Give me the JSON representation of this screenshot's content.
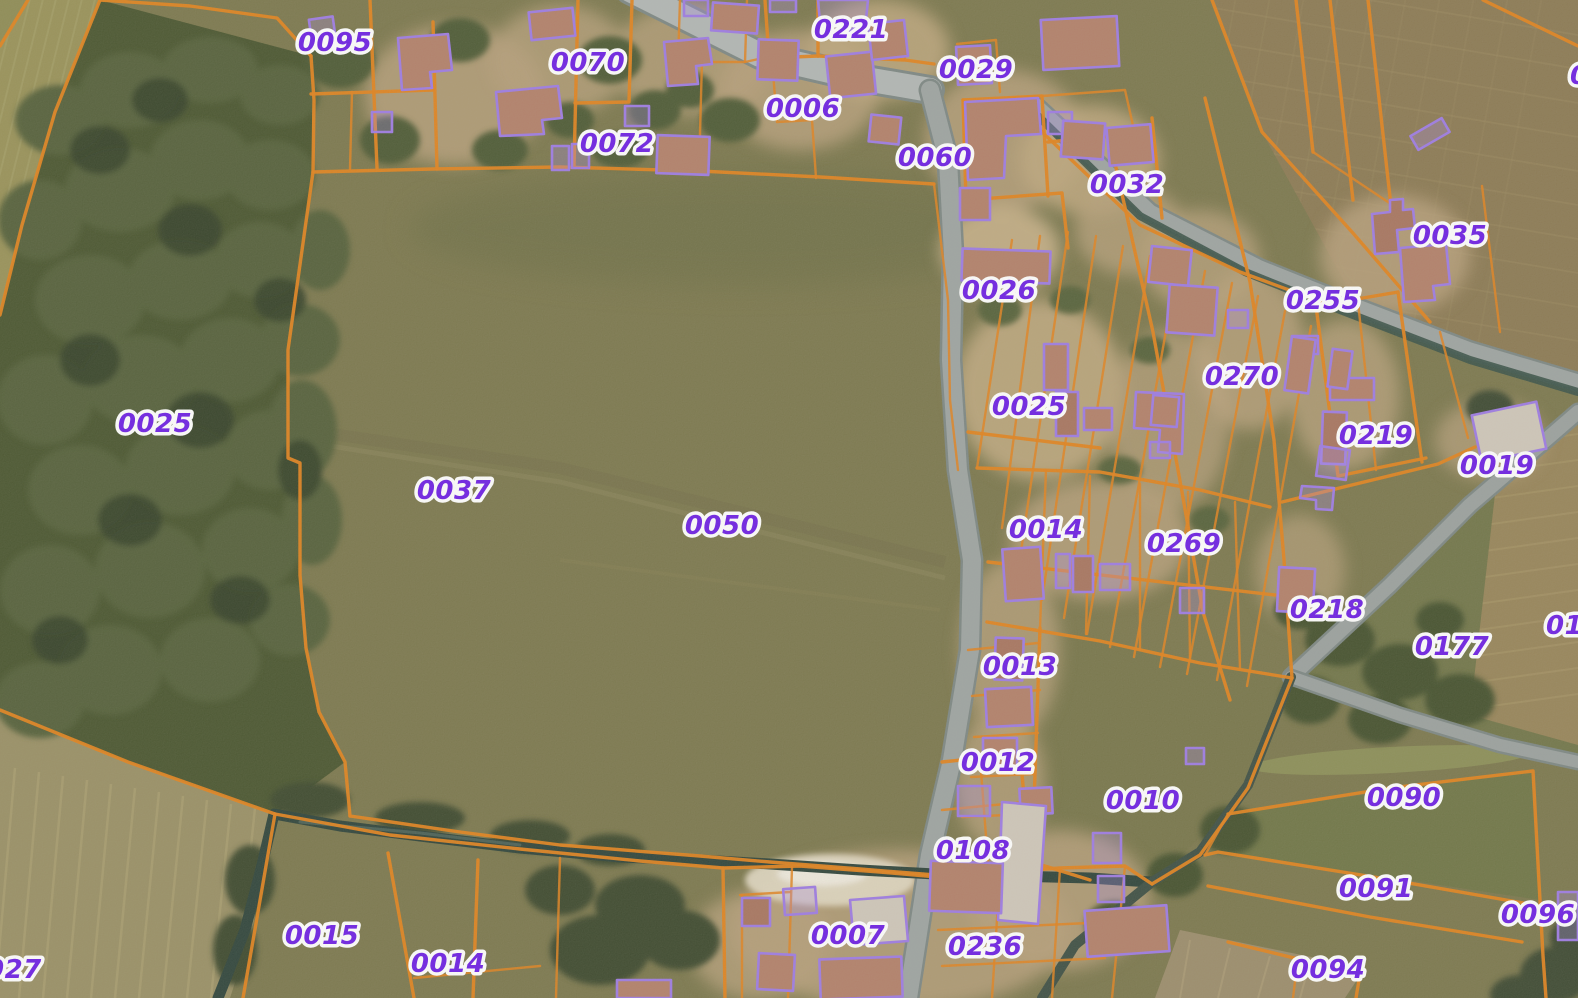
{
  "app": {
    "type": "cadastral-map-viewer",
    "view": "aerial orthophoto with cadastral parcel overlay"
  },
  "map": {
    "overlay": {
      "parcel_line_color": "#E2831E",
      "building_outline_color": "#9E7BE4",
      "label_color": "#6E1FE6",
      "label_halo_color": "#FFFFFF"
    },
    "terrain_colors": {
      "field_olive": "#7C784E",
      "forest_green": "#4A5630",
      "plowed_field": "#8C7A54",
      "light_field": "#9A9066",
      "village_ground": "#B7A07B",
      "road_gray": "#9EA4A2",
      "water_dark": "#2F443B",
      "roof_brown": "#B3806A"
    },
    "parcel_labels": [
      {
        "text": "0095",
        "x": 335,
        "y": 51,
        "anchor": "middle",
        "clipped": false
      },
      {
        "text": "0070",
        "x": 588,
        "y": 71,
        "anchor": "middle",
        "clipped": false
      },
      {
        "text": "0221",
        "x": 851,
        "y": 38,
        "anchor": "middle",
        "clipped": false
      },
      {
        "text": "0029",
        "x": 976,
        "y": 78,
        "anchor": "middle",
        "clipped": false
      },
      {
        "text": "0006",
        "x": 803,
        "y": 117,
        "anchor": "middle",
        "clipped": false
      },
      {
        "text": "0072",
        "x": 617,
        "y": 152,
        "anchor": "middle",
        "clipped": false
      },
      {
        "text": "0060",
        "x": 935,
        "y": 166,
        "anchor": "middle",
        "clipped": false
      },
      {
        "text": "0032",
        "x": 1127,
        "y": 193,
        "anchor": "middle",
        "clipped": false
      },
      {
        "text": "0035",
        "x": 1450,
        "y": 244,
        "anchor": "middle",
        "clipped": false
      },
      {
        "text": "0026",
        "x": 999,
        "y": 299,
        "anchor": "middle",
        "clipped": false
      },
      {
        "text": "0255",
        "x": 1323,
        "y": 309,
        "anchor": "middle",
        "clipped": false
      },
      {
        "text": "0270",
        "x": 1242,
        "y": 385,
        "anchor": "middle",
        "clipped": false
      },
      {
        "text": "0025",
        "x": 1029,
        "y": 415,
        "anchor": "middle",
        "clipped": false
      },
      {
        "text": "0219",
        "x": 1376,
        "y": 444,
        "anchor": "middle",
        "clipped": false
      },
      {
        "text": "0019",
        "x": 1497,
        "y": 474,
        "anchor": "middle",
        "clipped": false
      },
      {
        "text": "0025",
        "x": 155,
        "y": 432,
        "anchor": "middle",
        "clipped": false
      },
      {
        "text": "0037",
        "x": 454,
        "y": 499,
        "anchor": "middle",
        "clipped": false
      },
      {
        "text": "0050",
        "x": 722,
        "y": 534,
        "anchor": "middle",
        "clipped": false
      },
      {
        "text": "0014",
        "x": 1046,
        "y": 538,
        "anchor": "middle",
        "clipped": false
      },
      {
        "text": "0269",
        "x": 1184,
        "y": 552,
        "anchor": "middle",
        "clipped": false
      },
      {
        "text": "0218",
        "x": 1327,
        "y": 618,
        "anchor": "middle",
        "clipped": false
      },
      {
        "text": "0177",
        "x": 1452,
        "y": 655,
        "anchor": "middle",
        "clipped": false
      },
      {
        "text": "01",
        "x": 1546,
        "y": 634,
        "anchor": "start",
        "clipped": true
      },
      {
        "text": "0013",
        "x": 1020,
        "y": 675,
        "anchor": "middle",
        "clipped": false
      },
      {
        "text": "0012",
        "x": 998,
        "y": 771,
        "anchor": "middle",
        "clipped": false
      },
      {
        "text": "0010",
        "x": 1143,
        "y": 809,
        "anchor": "middle",
        "clipped": false
      },
      {
        "text": "0090",
        "x": 1404,
        "y": 806,
        "anchor": "middle",
        "clipped": false
      },
      {
        "text": "0108",
        "x": 973,
        "y": 859,
        "anchor": "middle",
        "clipped": false
      },
      {
        "text": "0091",
        "x": 1376,
        "y": 897,
        "anchor": "middle",
        "clipped": false
      },
      {
        "text": "0096",
        "x": 1538,
        "y": 923,
        "anchor": "middle",
        "clipped": false
      },
      {
        "text": "0015",
        "x": 322,
        "y": 944,
        "anchor": "middle",
        "clipped": false
      },
      {
        "text": "0007",
        "x": 848,
        "y": 944,
        "anchor": "middle",
        "clipped": false
      },
      {
        "text": "0236",
        "x": 985,
        "y": 955,
        "anchor": "middle",
        "clipped": false
      },
      {
        "text": "0014",
        "x": 448,
        "y": 972,
        "anchor": "middle",
        "clipped": false
      },
      {
        "text": "0094",
        "x": 1328,
        "y": 978,
        "anchor": "middle",
        "clipped": false
      },
      {
        "text": "027",
        "x": -14,
        "y": 978,
        "anchor": "start",
        "clipped": true
      },
      {
        "text": "0",
        "x": 1570,
        "y": 84,
        "anchor": "start",
        "clipped": true
      }
    ]
  }
}
